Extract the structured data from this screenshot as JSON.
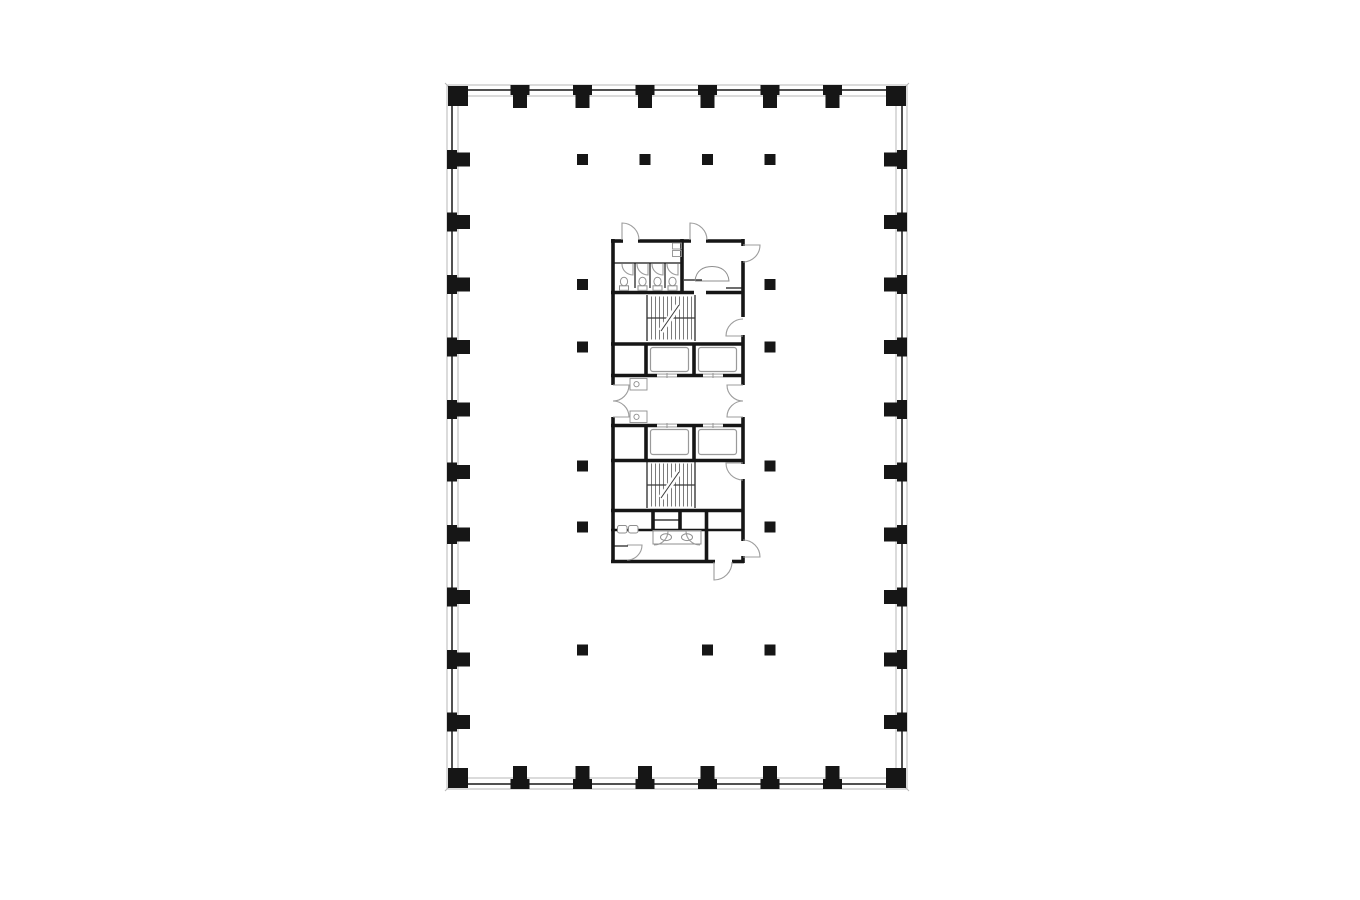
{
  "page": {
    "background": "#ffffff"
  },
  "plan": {
    "colors": {
      "ink": "#161616",
      "wall_dark": "#333333",
      "wall_light": "#b7b7b7",
      "swing": "#9c9c9c",
      "fixture": "#8f8f8f",
      "stair_tread": "#5a5a5a",
      "stair_line": "#3a3a3a",
      "car": "#9a9a9a"
    },
    "outer": {
      "x": 447,
      "y": 85,
      "w": 460,
      "h": 704
    },
    "corner_ticks": [
      [
        445,
        83,
        459,
        97
      ],
      [
        895,
        97,
        909,
        83
      ],
      [
        445,
        791,
        459,
        777
      ],
      [
        895,
        777,
        909,
        791
      ]
    ],
    "perimeter_columns": {
      "top_xs": [
        520,
        582.5,
        645,
        707.5,
        770,
        832.5
      ],
      "bottom_xs": [
        520,
        582.5,
        645,
        707.5,
        770,
        832.5
      ],
      "left_ys": [
        159.5,
        222,
        284.5,
        347,
        409.5,
        472,
        534.5,
        597,
        659.5,
        722
      ],
      "right_ys": [
        159.5,
        222,
        284.5,
        347,
        409.5,
        472,
        534.5,
        597,
        659.5,
        722
      ],
      "corner_size": 20
    },
    "interior_columns": {
      "size": 11,
      "points": [
        [
          582.5,
          159.5
        ],
        [
          645,
          159.5
        ],
        [
          707.5,
          159.5
        ],
        [
          770,
          159.5
        ],
        [
          582.5,
          284.5
        ],
        [
          770,
          284.5
        ],
        [
          582.5,
          347
        ],
        [
          770,
          347
        ],
        [
          582.5,
          466
        ],
        [
          770,
          466
        ],
        [
          582.5,
          527
        ],
        [
          770,
          527
        ],
        [
          582.5,
          650
        ],
        [
          707.5,
          650
        ],
        [
          770,
          650
        ]
      ]
    },
    "core": {
      "thick_walls": [
        [
          611,
          241,
          623,
          241
        ],
        [
          638,
          241,
          691,
          241
        ],
        [
          706,
          241,
          744,
          241
        ],
        [
          611,
          292.5,
          694,
          292.5
        ],
        [
          706,
          292.5,
          744,
          292.5
        ],
        [
          611,
          344,
          744,
          344
        ],
        [
          611,
          375.5,
          657,
          375.5
        ],
        [
          677,
          375.5,
          703,
          375.5
        ],
        [
          723,
          375.5,
          744,
          375.5
        ],
        [
          611,
          425.5,
          657,
          425.5
        ],
        [
          677,
          425.5,
          703,
          425.5
        ],
        [
          723,
          425.5,
          744,
          425.5
        ],
        [
          611,
          460.5,
          744,
          460.5
        ],
        [
          611,
          510.5,
          744,
          510.5
        ],
        [
          611,
          561.5,
          715,
          561.5
        ],
        [
          732,
          561.5,
          744,
          561.5
        ],
        [
          613,
          239,
          613,
          385
        ],
        [
          613,
          417,
          613,
          563
        ],
        [
          743,
          239,
          743,
          246
        ],
        [
          743,
          261,
          743,
          317
        ],
        [
          743,
          335,
          743,
          385
        ],
        [
          743,
          417,
          743,
          464
        ],
        [
          743,
          479,
          743,
          541
        ],
        [
          743,
          556,
          743,
          563
        ],
        [
          682,
          239,
          682,
          294
        ],
        [
          646,
          344,
          646,
          377
        ],
        [
          694,
          344,
          694,
          377
        ],
        [
          646,
          424,
          646,
          462
        ],
        [
          694,
          424,
          694,
          462
        ],
        [
          653,
          510,
          653,
          531
        ],
        [
          680,
          510,
          680,
          531
        ],
        [
          706.5,
          510,
          706.5,
          563
        ]
      ],
      "medium_walls": [
        [
          611,
          530,
          744,
          530
        ]
      ],
      "thin_walls": [
        [
          613,
          263,
          682,
          263
        ],
        [
          635,
          263,
          635,
          288
        ],
        [
          650,
          263,
          650,
          288
        ],
        [
          665,
          263,
          665,
          288
        ],
        [
          684,
          280,
          702,
          280
        ],
        [
          726,
          288,
          743,
          288
        ],
        [
          653,
          520,
          680,
          520
        ],
        [
          647,
          295,
          647,
          341
        ],
        [
          695,
          295,
          695,
          341
        ],
        [
          647,
          462,
          647,
          508
        ],
        [
          695,
          462,
          695,
          508
        ],
        [
          613,
          546,
          628,
          546
        ]
      ],
      "stairs": [
        {
          "x": 647,
          "y": 295,
          "w": 48,
          "h": 46,
          "tread_step": 4,
          "mid_y": 318,
          "break_line": [
            661,
            331,
            679,
            305
          ]
        },
        {
          "x": 647,
          "y": 462,
          "w": 48,
          "h": 46,
          "tread_step": 4,
          "mid_y": 485,
          "break_line": [
            661,
            498,
            679,
            472
          ]
        }
      ],
      "elevator_cars": [
        [
          650.5,
          347.5,
          38,
          24
        ],
        [
          698.5,
          347.5,
          38,
          24
        ],
        [
          650.5,
          429.5,
          38,
          25
        ],
        [
          698.5,
          429.5,
          38,
          25
        ]
      ],
      "elevator_doors": [
        {
          "x": 657,
          "y": 375.5,
          "w": 20
        },
        {
          "x": 703,
          "y": 375.5,
          "w": 20
        },
        {
          "x": 657,
          "y": 425.5,
          "w": 20
        },
        {
          "x": 703,
          "y": 425.5,
          "w": 20
        }
      ],
      "door_swings": [
        [
          622,
          240,
          17,
          -90,
          0
        ],
        [
          690,
          240,
          17,
          -90,
          0
        ],
        [
          743,
          245,
          17,
          0,
          90
        ],
        [
          743,
          336,
          17,
          180,
          270
        ],
        [
          613,
          385,
          16,
          0,
          90
        ],
        [
          613,
          417,
          16,
          0,
          -90
        ],
        [
          743,
          385,
          16,
          180,
          90
        ],
        [
          743,
          417,
          16,
          180,
          270
        ],
        [
          743,
          463,
          17,
          180,
          90
        ],
        [
          743,
          557,
          17,
          0,
          -90
        ],
        [
          714,
          562,
          18,
          90,
          0
        ],
        [
          627,
          545,
          15,
          0,
          90
        ],
        [
          633,
          264,
          11,
          90,
          180
        ],
        [
          648,
          264,
          11,
          90,
          180
        ],
        [
          663,
          264,
          11,
          90,
          180
        ],
        [
          678,
          264,
          11,
          90,
          180
        ],
        [
          654,
          531,
          14,
          0,
          90
        ],
        [
          700,
          531,
          14,
          180,
          90
        ]
      ],
      "toilets": {
        "centers_x": [
          624,
          642.5,
          657.5,
          672.5
        ],
        "tank_y": 285.8,
        "tank_w": 9,
        "tank_h": 4.5,
        "bowl_y": 281.5,
        "bowl_rx": 3.6,
        "bowl_ry": 4.3
      },
      "lobby_fixtures": {
        "boxes": [
          [
            630,
            378.5,
            17,
            11.5
          ],
          [
            630,
            411,
            17,
            11.5
          ]
        ],
        "circles": [
          [
            636.5,
            384.2,
            2.6
          ],
          [
            636.5,
            416.8,
            2.6
          ]
        ]
      },
      "service_fixture_rects": [
        [
          672.5,
          243,
          9,
          6
        ],
        [
          672.5,
          250.5,
          9,
          6
        ]
      ],
      "counter_curve": "M 695 281 C 696 270 704 266.5 712 266.5 C 720 266.5 728 270 729 281 L 695 281",
      "sinks": [
        [
          617.5,
          525.5,
          9.5,
          7.5
        ],
        [
          628.5,
          525.5,
          9.5,
          7.5
        ]
      ],
      "vanity": {
        "rect": [
          653,
          530.5,
          48,
          13.5
        ],
        "basins": [
          [
            666,
            537.2,
            5.5,
            3.4
          ],
          [
            687,
            537.2,
            5.5,
            3.4
          ]
        ]
      }
    }
  }
}
